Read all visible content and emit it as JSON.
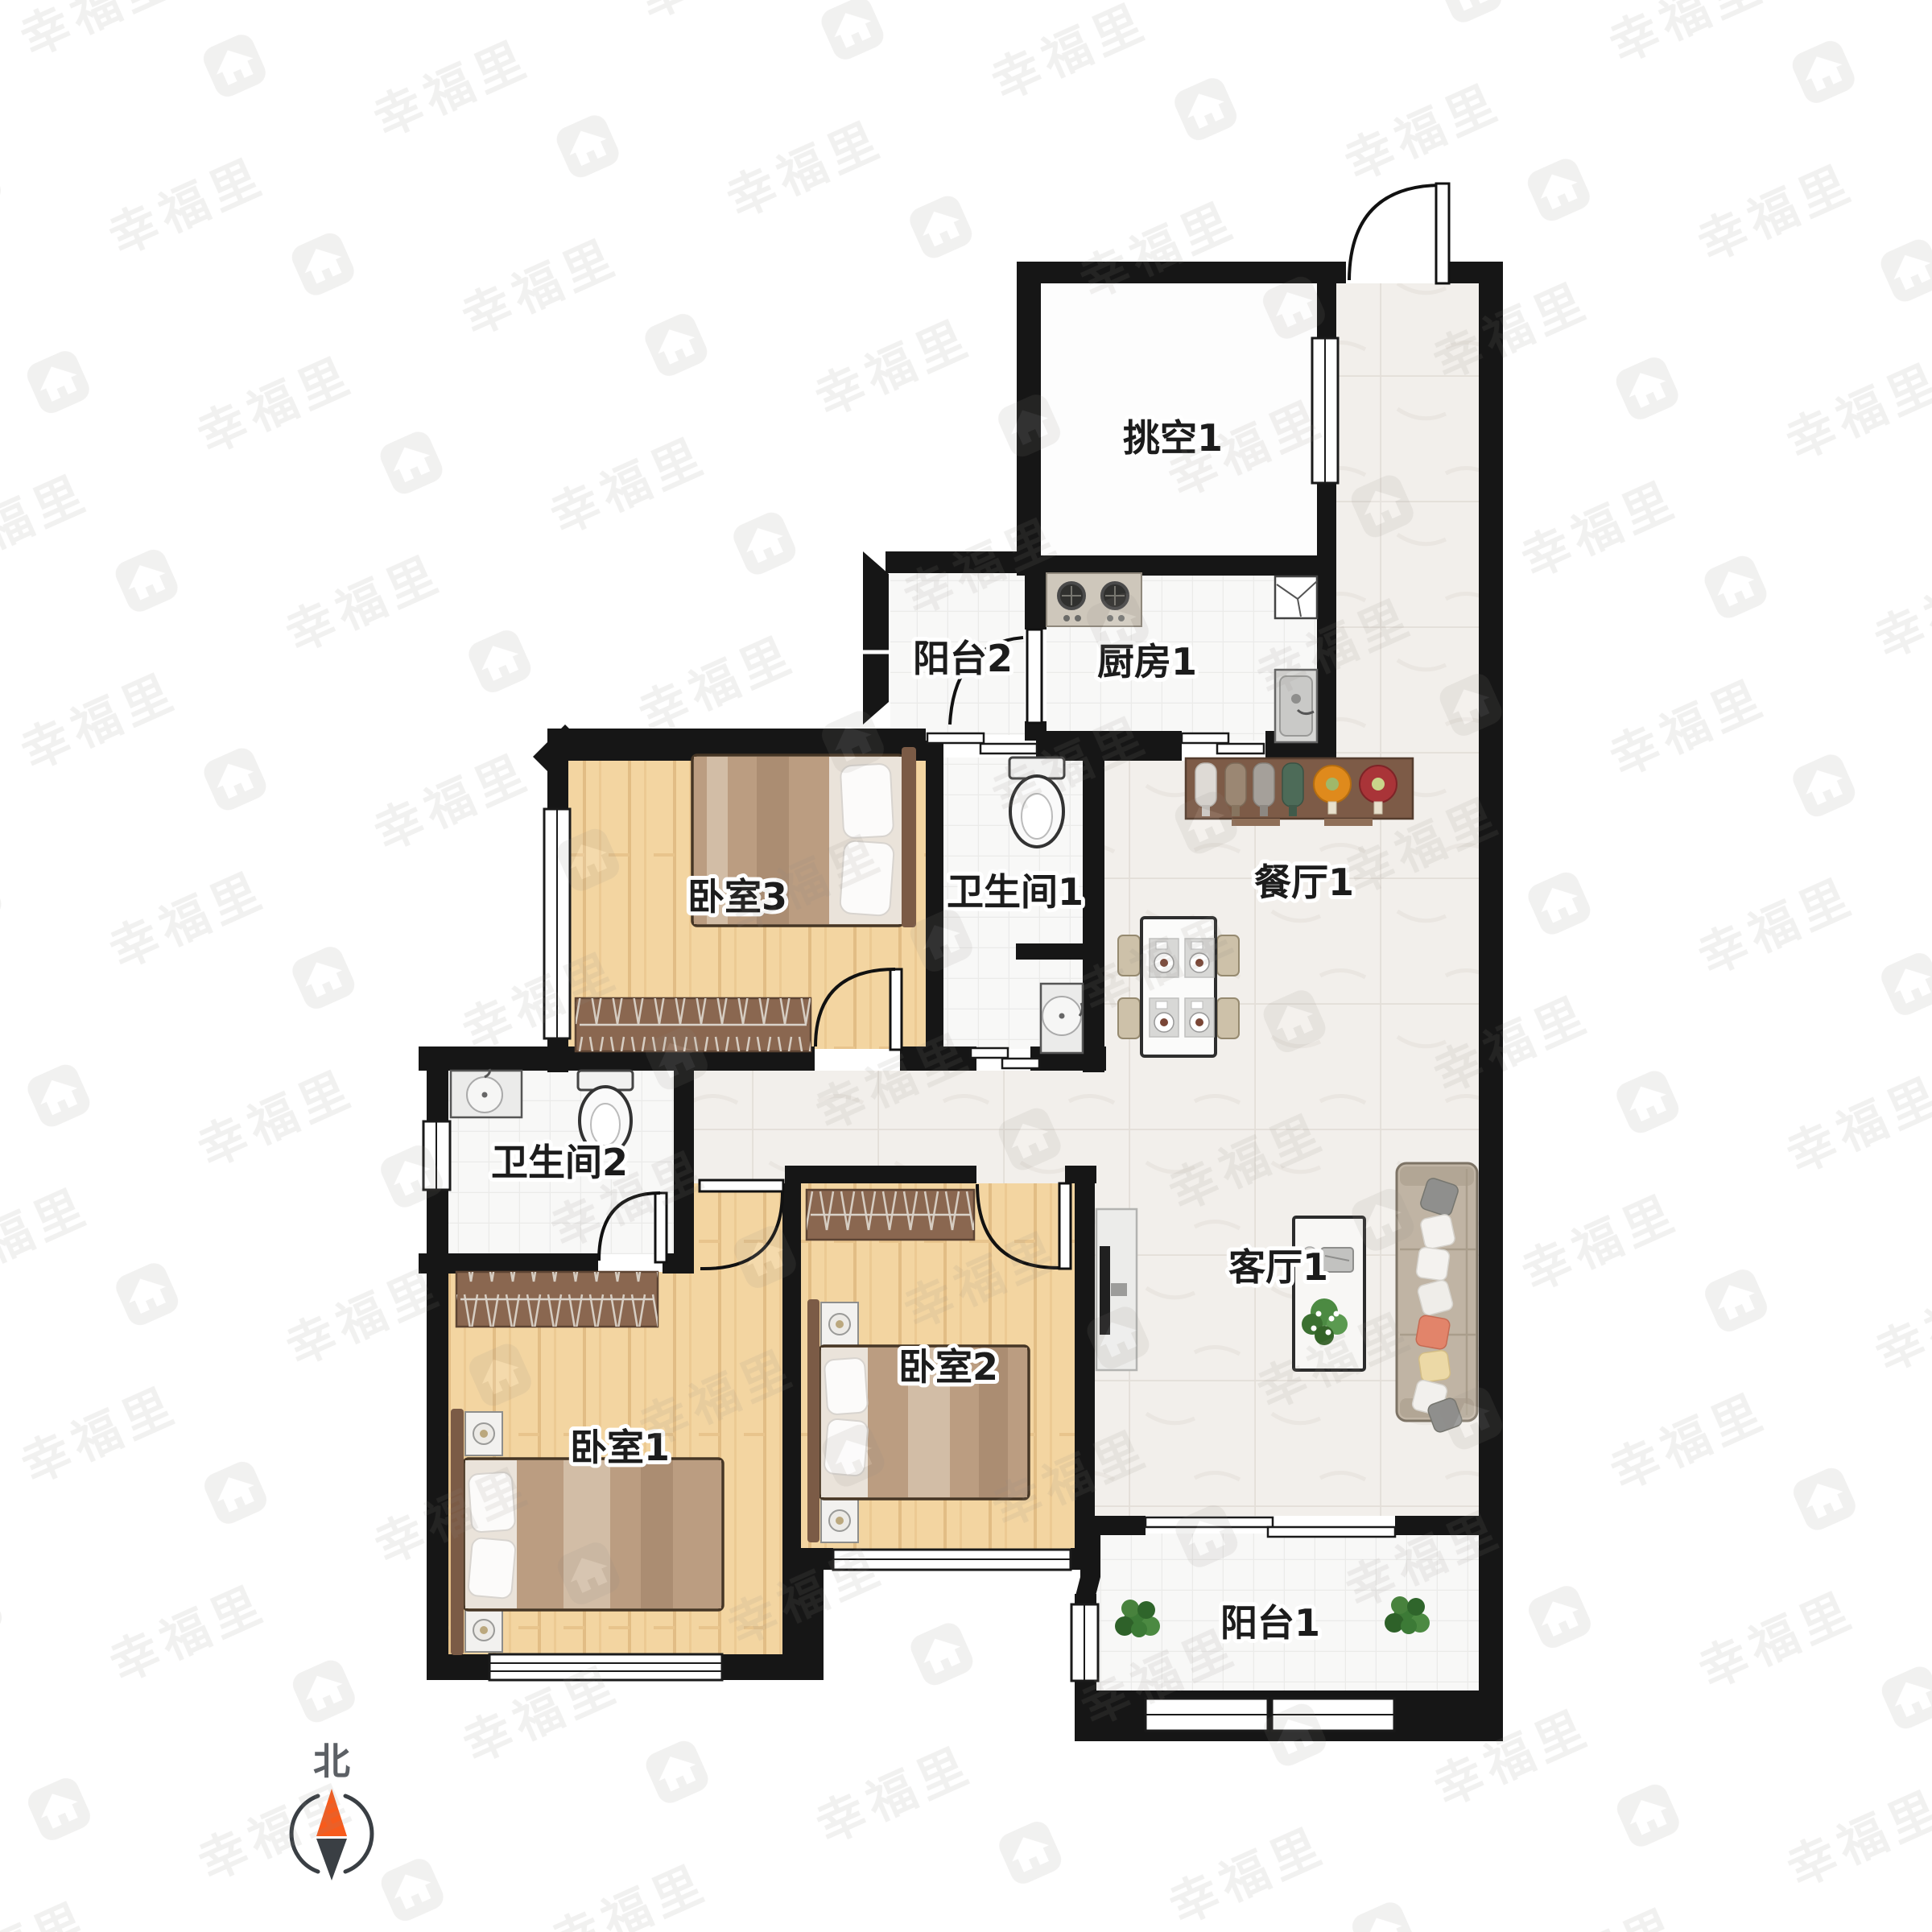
{
  "plan": {
    "type": "apartment-floor-plan",
    "rooms": [
      {
        "id": "void1",
        "label": "挑空1"
      },
      {
        "id": "balcony2",
        "label": "阳台2"
      },
      {
        "id": "kitchen1",
        "label": "厨房1"
      },
      {
        "id": "bath1",
        "label": "卫生间1"
      },
      {
        "id": "dining1",
        "label": "餐厅1"
      },
      {
        "id": "bedroom3",
        "label": "卧室3"
      },
      {
        "id": "bath2",
        "label": "卫生间2"
      },
      {
        "id": "bedroom1",
        "label": "卧室1"
      },
      {
        "id": "bedroom2",
        "label": "卧室2"
      },
      {
        "id": "living1",
        "label": "客厅1"
      },
      {
        "id": "balcony1",
        "label": "阳台1"
      }
    ],
    "compass": {
      "north_label": "北",
      "needle_north_color": "#f75b1c",
      "needle_south_color": "#3a3f44"
    },
    "watermark": {
      "text": "幸福里",
      "color": "#8d8781"
    },
    "colors": {
      "wall": "#161616",
      "wood_floor": "#f3d5a1",
      "tile_floor": "#f2efeb",
      "bath_floor": "#f8f8f7",
      "wardrobe": "#8a6750",
      "bed_blanket": "#bb9d81",
      "sofa": "#c0b4a4",
      "counter": "#7d5b47",
      "plant": "#3c7a36"
    }
  }
}
